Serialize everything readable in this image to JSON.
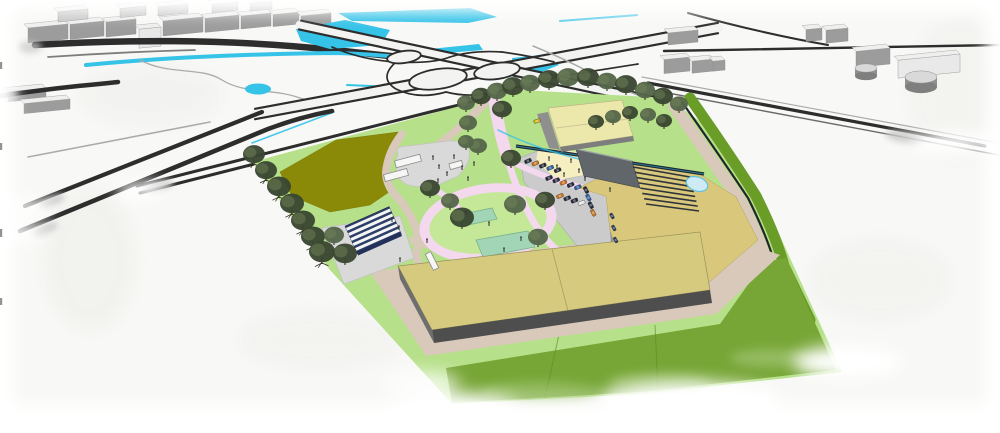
{
  "palette": {
    "paper": "#f8f8f6",
    "road_dark": "#2d2d2d",
    "road_gray": "#ababab",
    "road_white": "#f3f3f1",
    "water_cyan": "#35c3e8",
    "water_pale": "#cdeaf5",
    "water_edge": "#62c2dc",
    "green_light": "#b7e08a",
    "green_lawn": "#c4e897",
    "green_field": "#77a636",
    "green_band_dark": "#6a9c28",
    "green_seam": "#5f8a26",
    "olive_field": "#8a8a08",
    "path_beige": "#d8c9ba",
    "path_pink": "#f3d8ee",
    "plaza_gray": "#d9d9d9",
    "parking_gray": "#cbcbcb",
    "parking_edge": "#b2b2b2",
    "sand_yellow": "#f4eec0",
    "yard_khaki": "#d9c87b",
    "roof_tan": "#d5ca7e",
    "roof_edge": "#9a9259",
    "wall_dark": "#4e4e4e",
    "wall_mid": "#6e6e6e",
    "block_gray": "#61666b",
    "gable_roof": "#ece7aa",
    "gable_wall": "#8f8f8f",
    "terrace_line": "#2f343a",
    "court_green": "#a2d5b5",
    "court_edge": "#79b28c",
    "canopy_blue": "#2c3f68",
    "canopy_white": "#f5f5f5",
    "container_white": "#f6f6f5",
    "container_edge": "#8a8a8a",
    "bldg_front": "#9c9c9c",
    "bldg_back": "#c6c6c6",
    "bldg_top": "#efefee",
    "tank_gray": "#8f8f8f",
    "tree_dark": "#3a4731",
    "tree_mid": "#54664a",
    "tree_light": "#6f8258",
    "tree_trunk": "#2e2a20",
    "person_dark": "#3a3a3a",
    "car_dark": "#262b3c",
    "car_orange": "#c9761f",
    "car_blue": "#2f5fa4",
    "car_white": "#e8e8e8",
    "car_yellow": "#d8b31e",
    "bike_blue": "#2a3d66",
    "play_orange": "#e07820",
    "smudge_gray": "#c9c9c9",
    "paper_blob": "#ebebe8"
  },
  "scene": {
    "type": "architectural-aerial-render",
    "areas": [
      "motorway-interchange",
      "canal",
      "water-ponds",
      "industrial-buildings",
      "event-site",
      "olive-fields",
      "event-plaza",
      "solar-canopy-plaza",
      "playground-loop",
      "sports-courts",
      "parking-lot",
      "main-hall",
      "gable-barn",
      "terraced-stand",
      "retention-pond",
      "tree-rows",
      "green-berms",
      "farm-field"
    ]
  },
  "trees": [
    [
      466,
      110,
      9,
      1
    ],
    [
      481,
      104,
      10,
      0
    ],
    [
      497,
      99,
      10,
      1
    ],
    [
      513,
      95,
      11,
      0
    ],
    [
      530,
      91,
      10,
      1
    ],
    [
      549,
      88,
      11,
      0
    ],
    [
      568,
      86,
      11,
      1
    ],
    [
      588,
      86,
      11,
      0
    ],
    [
      607,
      89,
      10,
      1
    ],
    [
      626,
      93,
      11,
      0
    ],
    [
      645,
      98,
      10,
      1
    ],
    [
      663,
      104,
      10,
      0
    ],
    [
      679,
      111,
      9,
      1
    ],
    [
      596,
      128,
      8,
      0
    ],
    [
      613,
      123,
      8,
      1
    ],
    [
      630,
      119,
      8,
      0
    ],
    [
      648,
      121,
      8,
      1
    ],
    [
      664,
      127,
      8,
      0
    ],
    [
      254,
      163,
      11,
      2
    ],
    [
      266,
      179,
      11,
      2
    ],
    [
      279,
      196,
      12,
      2
    ],
    [
      292,
      213,
      12,
      2
    ],
    [
      303,
      230,
      12,
      2
    ],
    [
      313,
      246,
      12,
      2
    ],
    [
      322,
      262,
      13,
      2
    ],
    [
      468,
      130,
      9,
      1
    ],
    [
      502,
      117,
      10,
      0
    ],
    [
      478,
      153,
      9,
      1
    ],
    [
      511,
      166,
      10,
      0
    ],
    [
      430,
      196,
      10,
      0
    ],
    [
      450,
      208,
      9,
      1
    ],
    [
      462,
      227,
      12,
      0
    ],
    [
      466,
      148,
      8,
      1
    ],
    [
      515,
      213,
      11,
      1
    ],
    [
      545,
      208,
      10,
      0
    ],
    [
      538,
      245,
      10,
      1
    ],
    [
      345,
      263,
      12,
      0
    ],
    [
      334,
      243,
      10,
      1
    ]
  ],
  "people": [
    [
      433,
      160
    ],
    [
      439,
      169
    ],
    [
      447,
      176
    ],
    [
      454,
      159
    ],
    [
      462,
      170
    ],
    [
      438,
      183
    ],
    [
      468,
      181
    ],
    [
      474,
      166
    ],
    [
      549,
      161
    ],
    [
      557,
      169
    ],
    [
      564,
      177
    ],
    [
      571,
      163
    ],
    [
      579,
      173
    ],
    [
      466,
      215
    ],
    [
      489,
      226
    ],
    [
      504,
      252
    ],
    [
      427,
      243
    ],
    [
      521,
      241
    ],
    [
      400,
      262
    ],
    [
      610,
      192
    ],
    [
      585,
      181
    ],
    [
      392,
      222
    ],
    [
      399,
      230
    ]
  ],
  "vehicles": {
    "rows": [
      {
        "x": 528,
        "y": 161,
        "dx": 7.4,
        "dy": 2.3,
        "n": 5,
        "a": -22,
        "w": 7,
        "h": 3.6,
        "colors": [
          "dark",
          "orange",
          "dark",
          "blue",
          "dark"
        ]
      },
      {
        "x": 549,
        "y": 178,
        "dx": 7.2,
        "dy": 2.3,
        "n": 5,
        "a": -22,
        "w": 7,
        "h": 3.6,
        "colors": [
          "dark",
          "dark",
          "orange",
          "dark",
          "blue"
        ]
      },
      {
        "x": 560,
        "y": 196,
        "dx": 7.2,
        "dy": 2.3,
        "n": 4,
        "a": -22,
        "w": 7,
        "h": 3.6,
        "colors": [
          "orange",
          "dark",
          "dark",
          "white"
        ]
      },
      {
        "x": 586,
        "y": 190,
        "dx": 2.4,
        "dy": 7.6,
        "n": 4,
        "a": 62,
        "w": 7,
        "h": 3.6,
        "colors": [
          "dark",
          "blue",
          "dark",
          "orange"
        ]
      },
      {
        "x": 612,
        "y": 216,
        "dx": 1.8,
        "dy": 12,
        "n": 3,
        "a": 62,
        "w": 6,
        "h": 3,
        "colors": [
          "bike",
          "bike",
          "bike"
        ]
      },
      {
        "x": 537,
        "y": 121,
        "dx": 0,
        "dy": 0,
        "n": 1,
        "a": -20,
        "w": 6.5,
        "h": 3.4,
        "colors": [
          "yellow"
        ]
      }
    ]
  },
  "terraces": {
    "ax": 633,
    "ay": 167,
    "bx": 646,
    "by": 204,
    "cx": 690,
    "cy": 177,
    "dx": 699,
    "dy": 211,
    "n": 8
  },
  "outskirts": {
    "left_row": [
      [
        28,
        24,
        40,
        15,
        0
      ],
      [
        70,
        21,
        34,
        15,
        0
      ],
      [
        106,
        19,
        30,
        15,
        0
      ],
      [
        139,
        27,
        22,
        19,
        1
      ],
      [
        163,
        17,
        40,
        15,
        0
      ],
      [
        205,
        15,
        34,
        14,
        0
      ],
      [
        241,
        13,
        30,
        13,
        0
      ],
      [
        273,
        12,
        26,
        12,
        0
      ],
      [
        301,
        13,
        30,
        12,
        0
      ],
      [
        58,
        9,
        30,
        10,
        2
      ],
      [
        120,
        6,
        26,
        9,
        2
      ],
      [
        158,
        4,
        30,
        9,
        2
      ],
      [
        212,
        2,
        26,
        8,
        2
      ],
      [
        250,
        1,
        22,
        8,
        2
      ]
    ],
    "left_slabs": [
      [
        8,
        88,
        38,
        10,
        0
      ],
      [
        24,
        99,
        46,
        10,
        0
      ]
    ],
    "right_boxes": [
      [
        668,
        30,
        30,
        12,
        0
      ],
      [
        664,
        57,
        26,
        14,
        0
      ],
      [
        692,
        59,
        22,
        12,
        0
      ],
      [
        713,
        60,
        12,
        10,
        0
      ],
      [
        806,
        28,
        16,
        12,
        0
      ],
      [
        826,
        28,
        22,
        13,
        0
      ],
      [
        856,
        48,
        34,
        16,
        0
      ],
      [
        898,
        54,
        62,
        18,
        1
      ]
    ],
    "tanks": [
      [
        866,
        76,
        11,
        8
      ],
      [
        921,
        87,
        16,
        10
      ]
    ]
  }
}
